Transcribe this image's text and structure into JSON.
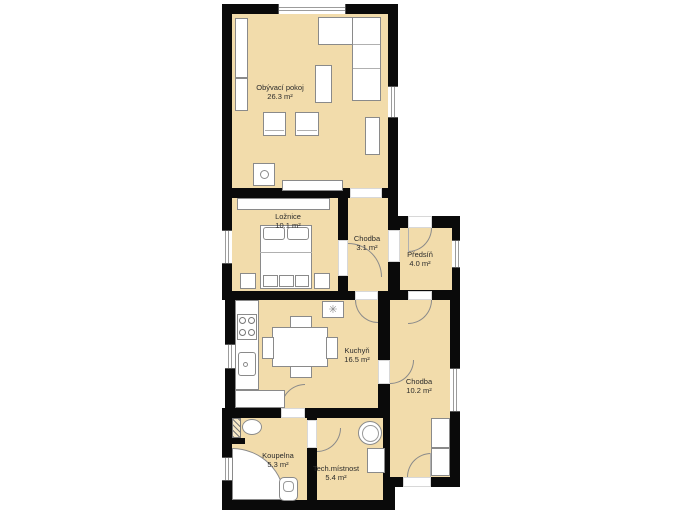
{
  "plan": {
    "rooms": [
      {
        "name": "Obývací pokoj",
        "area": "26.3 m²"
      },
      {
        "name": "Ložnice",
        "area": "10.1 m²"
      },
      {
        "name": "Chodba",
        "area": "3.1 m²"
      },
      {
        "name": "Předsíň",
        "area": "4.0 m²"
      },
      {
        "name": "Kuchyň",
        "area": "16.5 m²"
      },
      {
        "name": "Chodba",
        "area": "10.2 m²"
      },
      {
        "name": "Koupelna",
        "area": "5.3 m²"
      },
      {
        "name": "Tech.místnost",
        "area": "5.4 m²"
      }
    ],
    "colors": {
      "floor": "#f2dcab",
      "wall": "#0a0a0a",
      "furniture_outline": "#8a8a8a"
    },
    "icons": {
      "ceiling_fan_glyph": "✳"
    }
  }
}
